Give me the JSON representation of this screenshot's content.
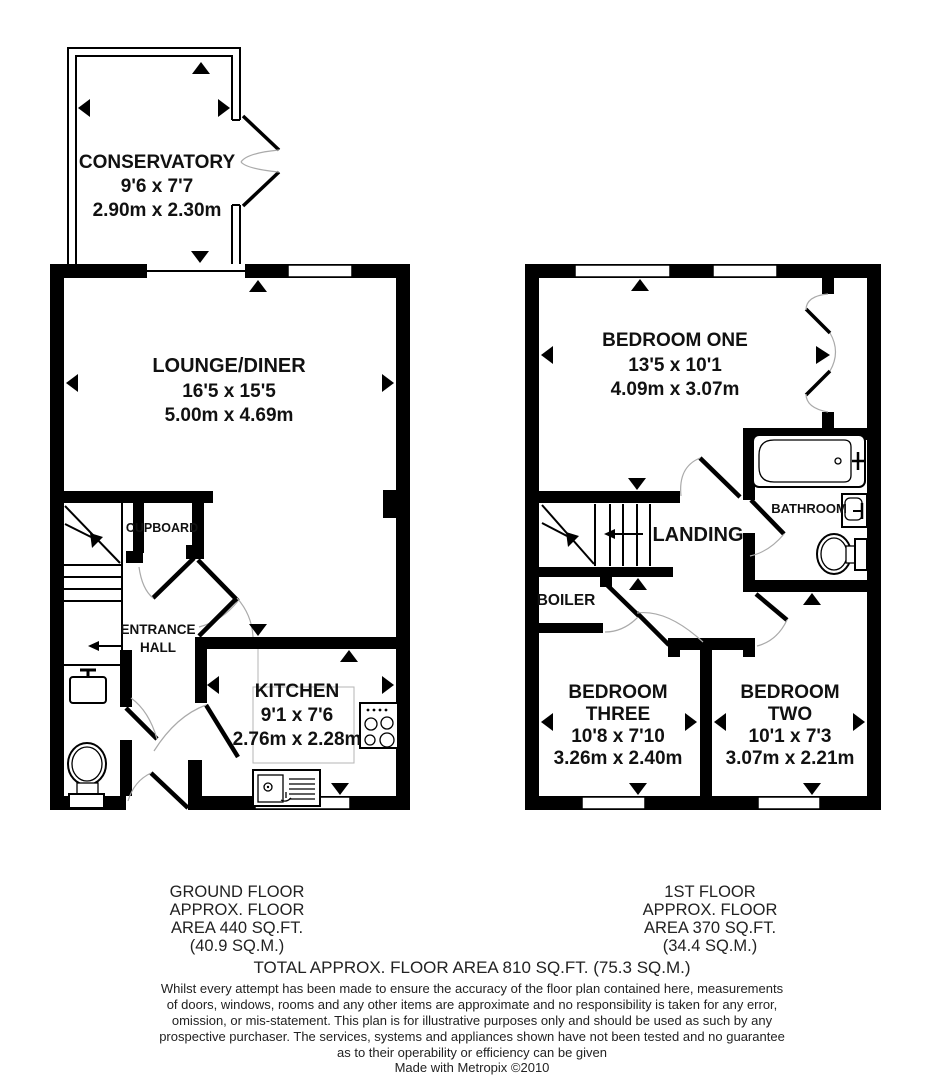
{
  "ground_floor": {
    "conservatory": {
      "name": "CONSERVATORY",
      "imperial": "9'6 x 7'7",
      "metric": "2.90m x 2.30m"
    },
    "lounge_diner": {
      "name": "LOUNGE/DINER",
      "imperial": "16'5 x 15'5",
      "metric": "5.00m x 4.69m"
    },
    "kitchen": {
      "name": "KITCHEN",
      "imperial": "9'1 x 7'6",
      "metric": "2.76m x 2.28m"
    },
    "cupboard": {
      "name": "CUPBOARD"
    },
    "entrance_hall": {
      "line1": "ENTRANCE",
      "line2": "HALL"
    },
    "area_label": {
      "line1": "GROUND FLOOR",
      "line2": "APPROX. FLOOR",
      "line3": "AREA 440 SQ.FT.",
      "line4": "(40.9 SQ.M.)"
    }
  },
  "first_floor": {
    "bedroom_one": {
      "name": "BEDROOM ONE",
      "imperial": "13'5 x 10'1",
      "metric": "4.09m x 3.07m"
    },
    "bedroom_two": {
      "line1": "BEDROOM",
      "line2": "TWO",
      "imperial": "10'1 x 7'3",
      "metric": "3.07m x 2.21m"
    },
    "bedroom_three": {
      "line1": "BEDROOM",
      "line2": "THREE",
      "imperial": "10'8 x 7'10",
      "metric": "3.26m x 2.40m"
    },
    "landing": {
      "name": "LANDING"
    },
    "bathroom": {
      "name": "BATHROOM"
    },
    "boiler": {
      "name": "BOILER"
    },
    "area_label": {
      "line1": "1ST FLOOR",
      "line2": "APPROX. FLOOR",
      "line3": "AREA 370 SQ.FT.",
      "line4": "(34.4 SQ.M.)"
    }
  },
  "footer": {
    "total": "TOTAL APPROX. FLOOR AREA 810 SQ.FT. (75.3 SQ.M.)",
    "disclaimer": [
      "Whilst every attempt has been made to ensure the accuracy of the floor plan contained here, measurements",
      "of doors, windows, rooms and any other items are approximate and no responsibility is taken for any error,",
      "omission, or mis-statement. This plan is for illustrative purposes only and should be used as such by any",
      "prospective purchaser. The services, systems and appliances shown have not been tested and no guarantee",
      "as to their operability or efficiency can be given"
    ],
    "credit": "Made with Metropix ©2010"
  },
  "colors": {
    "wall": "#000000",
    "door_arc": "#aaaaaa",
    "background": "#ffffff"
  }
}
